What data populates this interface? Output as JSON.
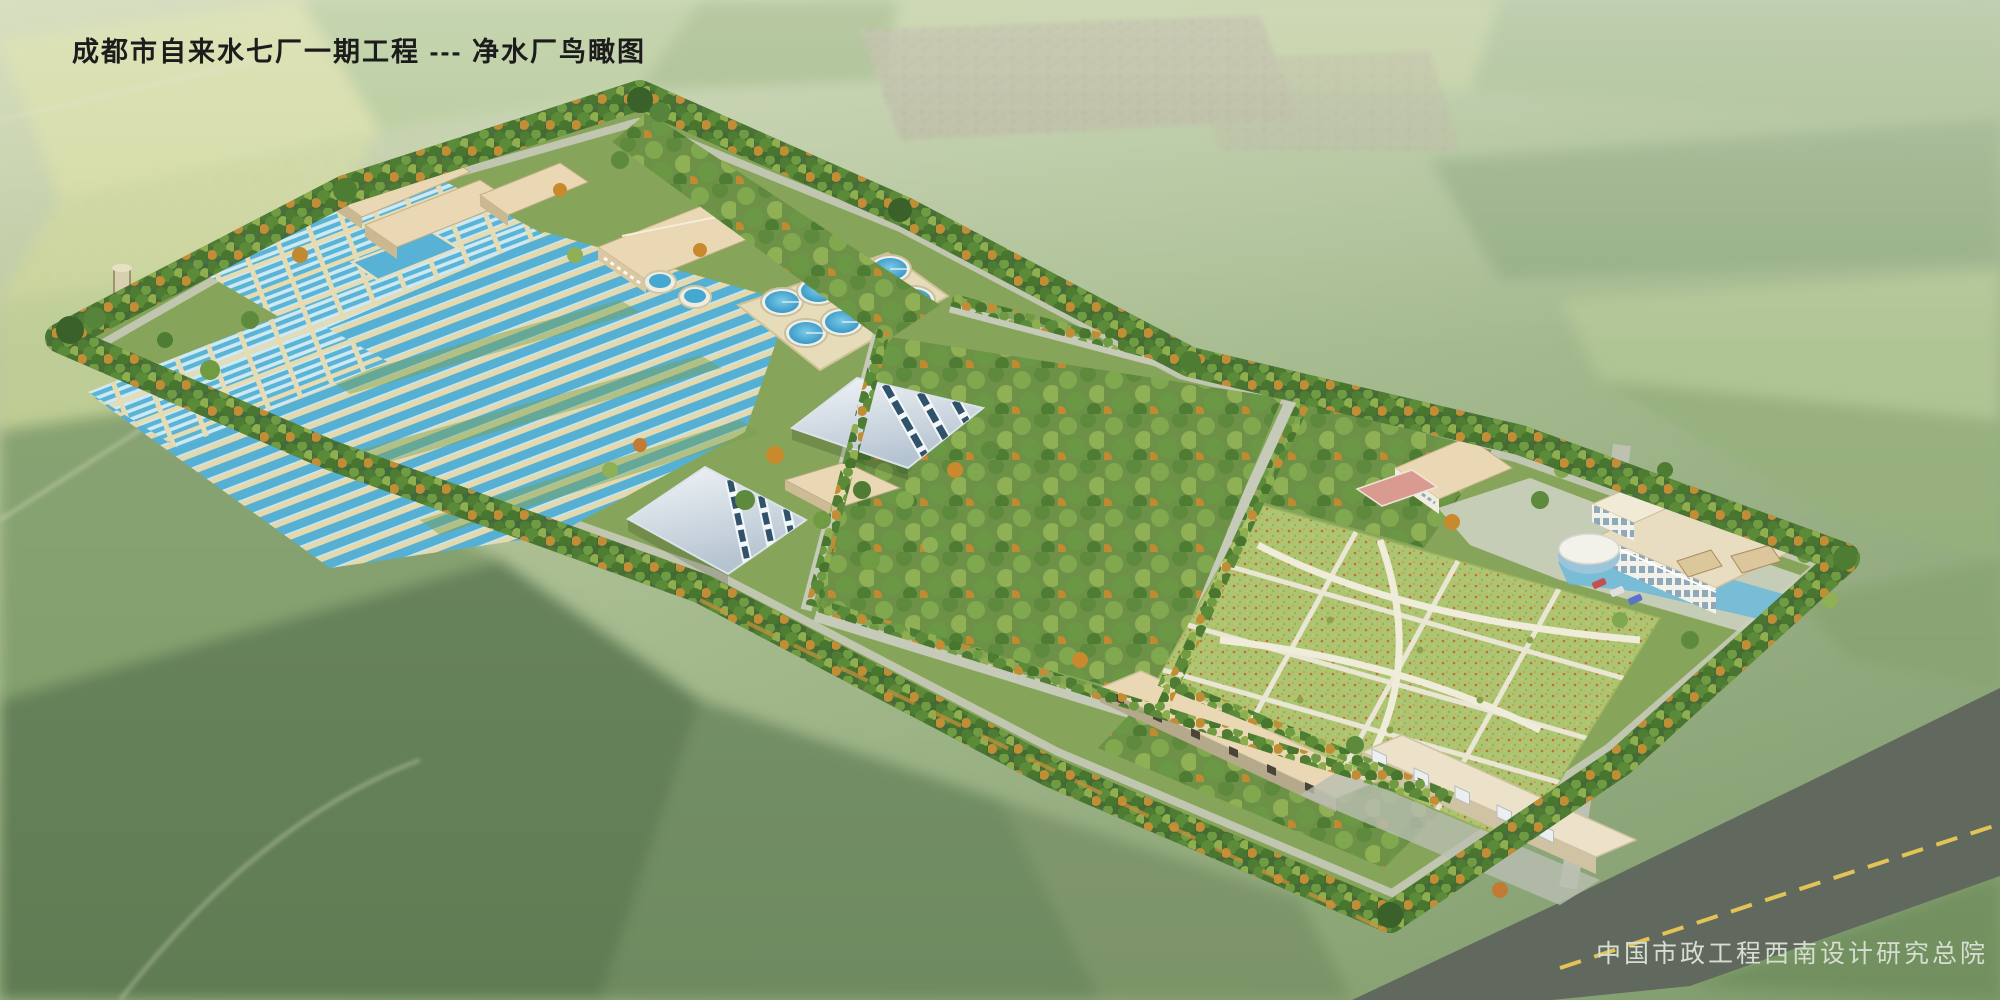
{
  "header": {
    "title": "成都市自来水七厂一期工程 --- 净水厂鸟瞰图"
  },
  "footer": {
    "credit": "中国市政工程西南设计研究总院"
  },
  "palette": {
    "title-ink": "#1c1c1c",
    "credit-ink": "#d6ded2",
    "pool-water": "#55b0d4",
    "pool-wall": "#e4d9ae",
    "tank-water": "#3f9ecc",
    "roof-beige": "#ead8b4",
    "site-grass": "#86a55a",
    "tree-dark": "#3f6630",
    "lawn-green": "#adc571",
    "road-concrete": "#c6cab8",
    "road-asphalt": "#61685e",
    "road-centerline": "#e2c355",
    "building-white": "#f2f1ea",
    "pond-blue": "#6ab8da",
    "court-pink": "#d99a90"
  }
}
